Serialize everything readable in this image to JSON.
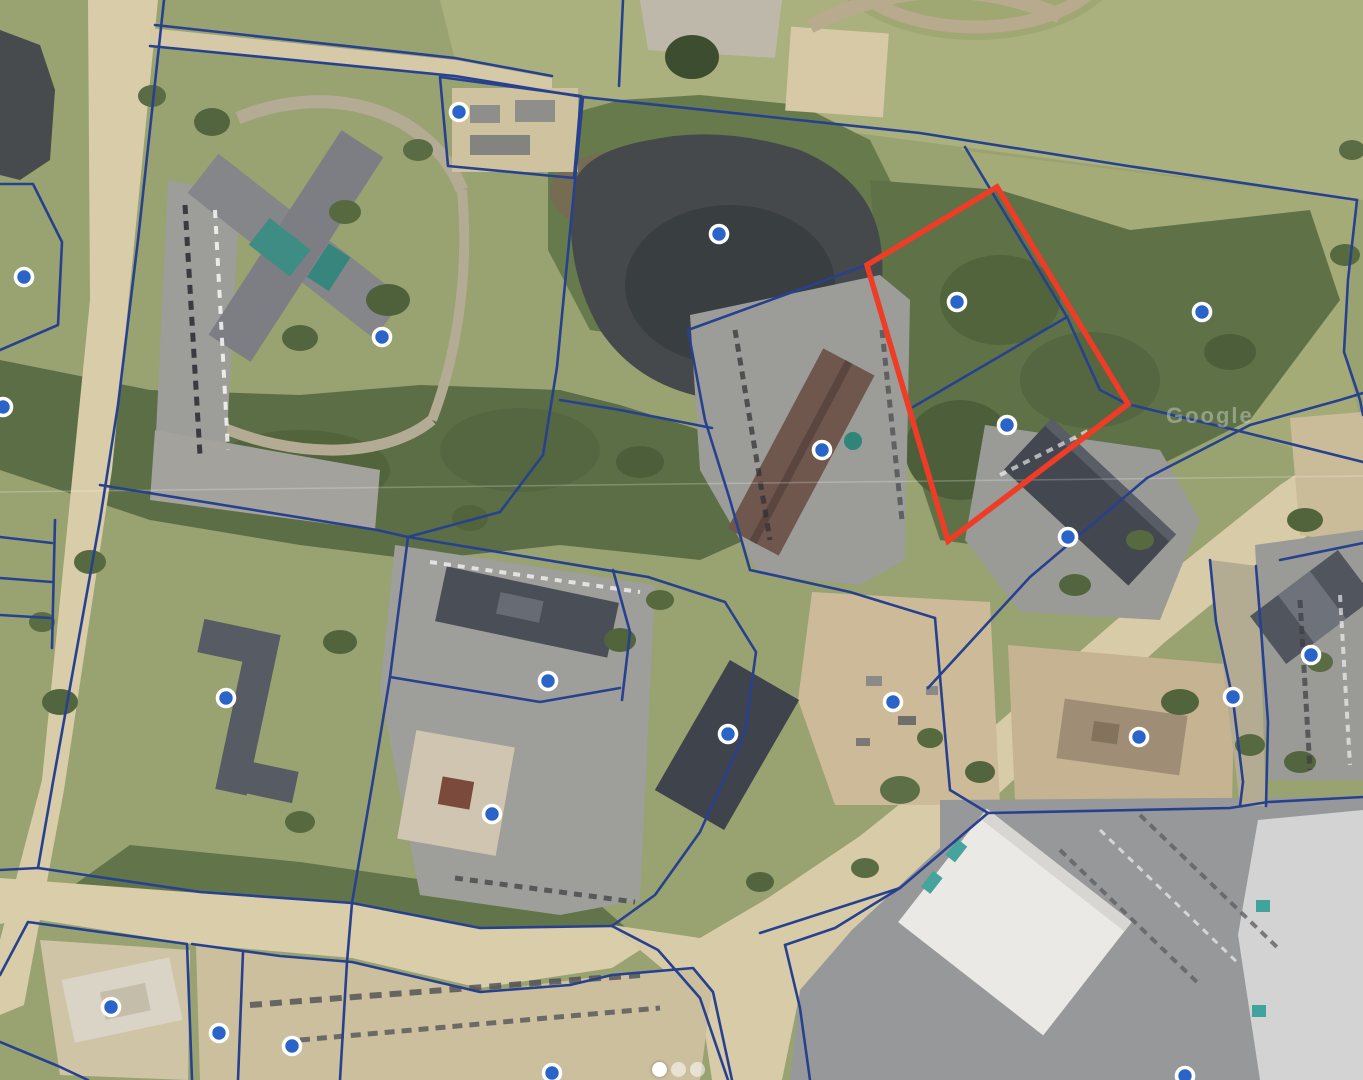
{
  "map": {
    "watermark": "Google",
    "colors": {
      "boundary": "#27418F",
      "highlight": "#EE3C26",
      "marker_fill": "#2B64C9",
      "marker_ring": "#FFFFFF"
    },
    "highlighted_parcel": {
      "points": [
        [
          997,
          187
        ],
        [
          867,
          265
        ],
        [
          948,
          541
        ],
        [
          1128,
          404
        ]
      ]
    },
    "markers": [
      {
        "x": 459,
        "y": 112
      },
      {
        "x": 24,
        "y": 277
      },
      {
        "x": 3,
        "y": 407
      },
      {
        "x": 382,
        "y": 337
      },
      {
        "x": 719,
        "y": 234
      },
      {
        "x": 957,
        "y": 302
      },
      {
        "x": 1202,
        "y": 312
      },
      {
        "x": 822,
        "y": 450
      },
      {
        "x": 1007,
        "y": 425
      },
      {
        "x": 1068,
        "y": 537
      },
      {
        "x": 226,
        "y": 698
      },
      {
        "x": 548,
        "y": 681
      },
      {
        "x": 728,
        "y": 734
      },
      {
        "x": 893,
        "y": 702
      },
      {
        "x": 1139,
        "y": 737
      },
      {
        "x": 1311,
        "y": 655
      },
      {
        "x": 1233,
        "y": 697
      },
      {
        "x": 492,
        "y": 814
      },
      {
        "x": 111,
        "y": 1007
      },
      {
        "x": 219,
        "y": 1033
      },
      {
        "x": 292,
        "y": 1046
      },
      {
        "x": 552,
        "y": 1073
      },
      {
        "x": 1185,
        "y": 1076
      }
    ],
    "boundaries": [
      [
        [
          155,
          25
        ],
        [
          455,
          58
        ],
        [
          552,
          76
        ]
      ],
      [
        [
          150,
          46
        ],
        [
          455,
          76
        ],
        [
          583,
          97
        ],
        [
          920,
          133
        ],
        [
          1128,
          166
        ],
        [
          1357,
          200
        ]
      ],
      [
        [
          623,
          0
        ],
        [
          619,
          86
        ]
      ],
      [
        [
          1357,
          200
        ],
        [
          1348,
          280
        ],
        [
          1344,
          352
        ],
        [
          1360,
          400
        ],
        [
          1363,
          415
        ]
      ],
      [
        [
          164,
          0
        ],
        [
          138,
          240
        ],
        [
          118,
          405
        ],
        [
          100,
          520
        ],
        [
          53,
          782
        ],
        [
          38,
          868
        ]
      ],
      [
        [
          440,
          77
        ],
        [
          581,
          96
        ],
        [
          574,
          178
        ],
        [
          448,
          166
        ],
        [
          440,
          77
        ]
      ],
      [
        [
          583,
          97
        ],
        [
          557,
          367
        ],
        [
          543,
          455
        ],
        [
          500,
          512
        ],
        [
          408,
          537
        ]
      ],
      [
        [
          100,
          485
        ],
        [
          377,
          530
        ],
        [
          408,
          537
        ]
      ],
      [
        [
          408,
          537
        ],
        [
          390,
          677
        ],
        [
          373,
          780
        ],
        [
          352,
          903
        ]
      ],
      [
        [
          38,
          868
        ],
        [
          200,
          892
        ],
        [
          352,
          903
        ],
        [
          480,
          928
        ],
        [
          612,
          926
        ]
      ],
      [
        [
          0,
          870
        ],
        [
          38,
          868
        ]
      ],
      [
        [
          612,
          926
        ],
        [
          658,
          950
        ],
        [
          700,
          998
        ],
        [
          728,
          1080
        ]
      ],
      [
        [
          760,
          933
        ],
        [
          900,
          888
        ],
        [
          988,
          813
        ],
        [
          1230,
          808
        ],
        [
          1268,
          802
        ],
        [
          1363,
          797
        ]
      ],
      [
        [
          785,
          945
        ],
        [
          800,
          1008
        ],
        [
          810,
          1080
        ]
      ],
      [
        [
          785,
          945
        ],
        [
          835,
          928
        ],
        [
          900,
          888
        ]
      ],
      [
        [
          0,
          975
        ],
        [
          28,
          922
        ],
        [
          187,
          944
        ],
        [
          192,
          1080
        ]
      ],
      [
        [
          243,
          952
        ],
        [
          238,
          1080
        ]
      ],
      [
        [
          352,
          903
        ],
        [
          347,
          962
        ],
        [
          340,
          1080
        ]
      ],
      [
        [
          192,
          944
        ],
        [
          280,
          956
        ],
        [
          352,
          962
        ],
        [
          480,
          992
        ],
        [
          570,
          985
        ],
        [
          612,
          975
        ],
        [
          693,
          968
        ],
        [
          713,
          992
        ],
        [
          732,
          1080
        ]
      ],
      [
        [
          0,
          537
        ],
        [
          52,
          543
        ]
      ],
      [
        [
          0,
          578
        ],
        [
          52,
          582
        ]
      ],
      [
        [
          0,
          615
        ],
        [
          50,
          618
        ]
      ],
      [
        [
          55,
          520
        ],
        [
          52,
          648
        ]
      ],
      [
        [
          0,
          184
        ],
        [
          33,
          184
        ],
        [
          62,
          242
        ],
        [
          58,
          325
        ],
        [
          0,
          350
        ]
      ],
      [
        [
          0,
          1042
        ],
        [
          58,
          1066
        ],
        [
          88,
          1080
        ]
      ],
      [
        [
          408,
          537
        ],
        [
          648,
          577
        ]
      ],
      [
        [
          613,
          570
        ],
        [
          630,
          632
        ],
        [
          622,
          700
        ]
      ],
      [
        [
          390,
          677
        ],
        [
          540,
          702
        ],
        [
          620,
          688
        ]
      ],
      [
        [
          648,
          577
        ],
        [
          725,
          602
        ],
        [
          756,
          652
        ],
        [
          745,
          732
        ],
        [
          700,
          832
        ],
        [
          655,
          895
        ],
        [
          612,
          926
        ]
      ],
      [
        [
          688,
          330
        ],
        [
          867,
          265
        ]
      ],
      [
        [
          688,
          330
        ],
        [
          705,
          420
        ],
        [
          730,
          500
        ],
        [
          750,
          570
        ]
      ],
      [
        [
          750,
          570
        ],
        [
          850,
          592
        ],
        [
          935,
          618
        ]
      ],
      [
        [
          560,
          400
        ],
        [
          620,
          410
        ],
        [
          712,
          428
        ]
      ],
      [
        [
          965,
          147
        ],
        [
          1067,
          317
        ],
        [
          1100,
          390
        ],
        [
          1127,
          404
        ]
      ],
      [
        [
          913,
          407
        ],
        [
          1067,
          317
        ]
      ],
      [
        [
          867,
          265
        ],
        [
          948,
          540
        ]
      ],
      [
        [
          1127,
          404
        ],
        [
          1235,
          430
        ],
        [
          1363,
          462
        ]
      ],
      [
        [
          928,
          688
        ],
        [
          1030,
          577
        ],
        [
          1147,
          478
        ],
        [
          1250,
          425
        ],
        [
          1340,
          400
        ],
        [
          1363,
          393
        ]
      ],
      [
        [
          935,
          618
        ],
        [
          942,
          700
        ],
        [
          950,
          790
        ],
        [
          988,
          813
        ]
      ],
      [
        [
          1210,
          560
        ],
        [
          1216,
          622
        ],
        [
          1233,
          700
        ],
        [
          1243,
          782
        ],
        [
          1240,
          806
        ]
      ],
      [
        [
          1256,
          566
        ],
        [
          1262,
          642
        ],
        [
          1268,
          722
        ],
        [
          1266,
          806
        ]
      ],
      [
        [
          1280,
          560
        ],
        [
          1363,
          543
        ]
      ]
    ]
  },
  "carousel": {
    "active_index": 0,
    "dots": [
      "active",
      "inactive",
      "inactive"
    ]
  }
}
